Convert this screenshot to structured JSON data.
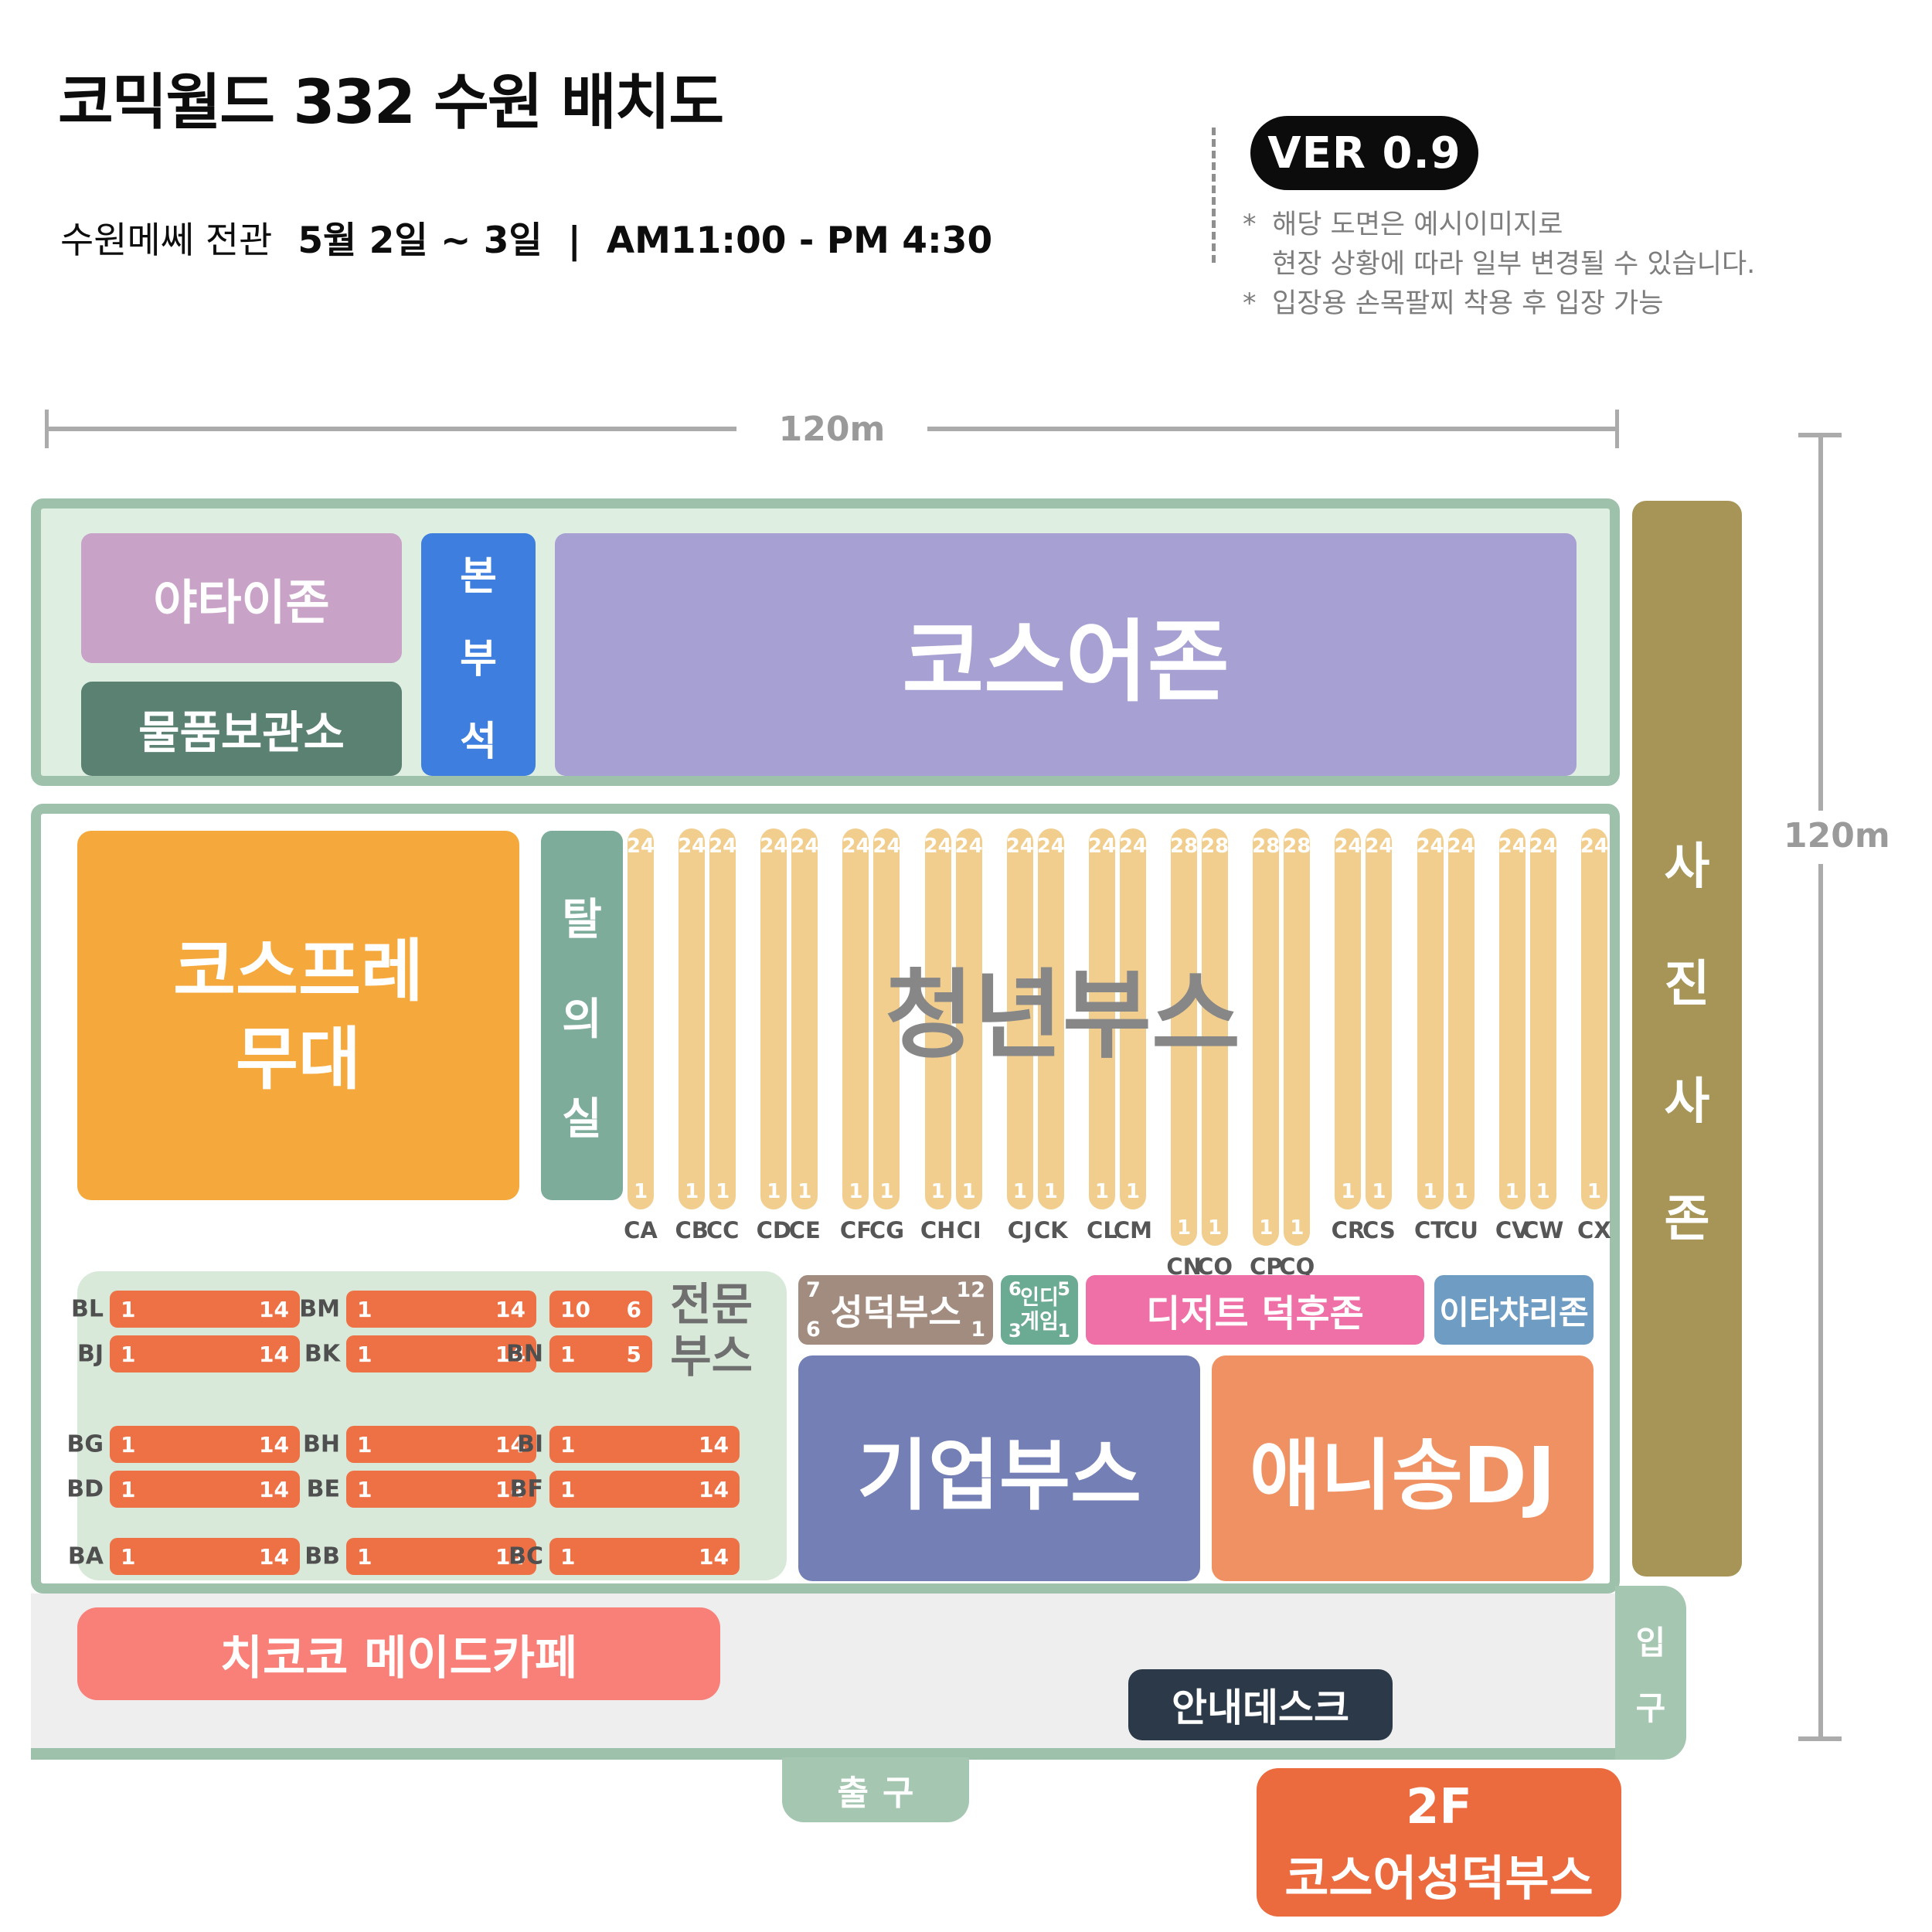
{
  "header": {
    "title": "코믹월드 332 수원 배치도",
    "subtitle_venue": "수원메쎄 전관",
    "subtitle_date": "5월 2일 ~ 3일",
    "subtitle_sep": "|",
    "subtitle_time": "AM11:00 - PM 4:30",
    "version_badge": "VER 0.9",
    "notes": [
      {
        "mark": "*",
        "line1": "해당 도면은 예시이미지로",
        "line2": "현장 상황에 따라 일부 변경될 수 있습니다."
      },
      {
        "mark": "*",
        "line1": "입장용 손목팔찌 착용 후 입장 가능",
        "line2": ""
      }
    ]
  },
  "dimensions": {
    "width_label": "120m",
    "height_label": "120m"
  },
  "zones": {
    "yatai": "야타이존",
    "storage": "물품보관소",
    "hq": "본부석",
    "cosplayer_zone": "코스어존",
    "stage_line1": "코스프레",
    "stage_line2": "무대",
    "dressing_room": "탈의실",
    "youth_booth": "청년부스",
    "dessert": "디저트 덕후존",
    "itachari": "이타챠리존",
    "corporate": "기업부스",
    "anisong": "애니송DJ",
    "photo_zone": "사진사존",
    "maid_cafe": "치코코 메이드카페",
    "info_desk": "안내데스크",
    "entrance": "입구",
    "exit": "출구",
    "floor2_line1": "2F",
    "floor2_line2": "코스어성덕부스"
  },
  "seongdeok_booth": {
    "name": "성덕부스",
    "tl": "7",
    "tr": "12",
    "bl": "6",
    "br": "1"
  },
  "indie_game": {
    "line1": "인디",
    "line2": "게임",
    "tl": "6",
    "tr": "5",
    "bl": "3",
    "br": "1"
  },
  "youth_booth": {
    "groups": [
      [
        {
          "id": "CA",
          "top": "24",
          "bottom": "1",
          "long": false
        }
      ],
      [
        {
          "id": "CB",
          "top": "24",
          "bottom": "1",
          "long": false
        },
        {
          "id": "CC",
          "top": "24",
          "bottom": "1",
          "long": false
        }
      ],
      [
        {
          "id": "CD",
          "top": "24",
          "bottom": "1",
          "long": false
        },
        {
          "id": "CE",
          "top": "24",
          "bottom": "1",
          "long": false
        }
      ],
      [
        {
          "id": "CF",
          "top": "24",
          "bottom": "1",
          "long": false
        },
        {
          "id": "CG",
          "top": "24",
          "bottom": "1",
          "long": false
        }
      ],
      [
        {
          "id": "CH",
          "top": "24",
          "bottom": "1",
          "long": false
        },
        {
          "id": "CI",
          "top": "24",
          "bottom": "1",
          "long": false
        }
      ],
      [
        {
          "id": "CJ",
          "top": "24",
          "bottom": "1",
          "long": false
        },
        {
          "id": "CK",
          "top": "24",
          "bottom": "1",
          "long": false
        }
      ],
      [
        {
          "id": "CL",
          "top": "24",
          "bottom": "1",
          "long": false
        },
        {
          "id": "CM",
          "top": "24",
          "bottom": "1",
          "long": false
        }
      ],
      [
        {
          "id": "CN",
          "top": "28",
          "bottom": "1",
          "long": true
        },
        {
          "id": "CO",
          "top": "28",
          "bottom": "1",
          "long": true
        }
      ],
      [
        {
          "id": "CP",
          "top": "28",
          "bottom": "1",
          "long": true
        },
        {
          "id": "CQ",
          "top": "28",
          "bottom": "1",
          "long": true
        }
      ],
      [
        {
          "id": "CR",
          "top": "24",
          "bottom": "1",
          "long": false
        },
        {
          "id": "CS",
          "top": "24",
          "bottom": "1",
          "long": false
        }
      ],
      [
        {
          "id": "CT",
          "top": "24",
          "bottom": "1",
          "long": false
        },
        {
          "id": "CU",
          "top": "24",
          "bottom": "1",
          "long": false
        }
      ],
      [
        {
          "id": "CV",
          "top": "24",
          "bottom": "1",
          "long": false
        },
        {
          "id": "CW",
          "top": "24",
          "bottom": "1",
          "long": false
        }
      ],
      [
        {
          "id": "CX",
          "top": "24",
          "bottom": "1",
          "long": false
        }
      ]
    ]
  },
  "pro_booth": {
    "label_line1": "전문",
    "label_line2": "부스",
    "rows": [
      {
        "cells": [
          {
            "col": 0,
            "label": "BL",
            "left": "1",
            "right": "14",
            "size": "full"
          },
          {
            "col": 1,
            "label": "BM",
            "left": "1",
            "right": "14",
            "size": "full"
          },
          {
            "col": 2,
            "label": "",
            "left": "10",
            "right": "6",
            "size": "short"
          }
        ]
      },
      {
        "cells": [
          {
            "col": 0,
            "label": "BJ",
            "left": "1",
            "right": "14",
            "size": "full"
          },
          {
            "col": 1,
            "label": "BK",
            "left": "1",
            "right": "14",
            "size": "full"
          },
          {
            "col": 2,
            "label": "BN",
            "left": "1",
            "right": "5",
            "size": "short"
          }
        ]
      },
      {
        "cells": [
          {
            "col": 0,
            "label": "BG",
            "left": "1",
            "right": "14",
            "size": "full"
          },
          {
            "col": 1,
            "label": "BH",
            "left": "1",
            "right": "14",
            "size": "full"
          },
          {
            "col": 2,
            "label": "BI",
            "left": "1",
            "right": "14",
            "size": "full"
          }
        ]
      },
      {
        "cells": [
          {
            "col": 0,
            "label": "BD",
            "left": "1",
            "right": "14",
            "size": "full"
          },
          {
            "col": 1,
            "label": "BE",
            "left": "1",
            "right": "14",
            "size": "full"
          },
          {
            "col": 2,
            "label": "BF",
            "left": "1",
            "right": "14",
            "size": "full"
          }
        ]
      },
      {
        "cells": [
          {
            "col": 0,
            "label": "BA",
            "left": "1",
            "right": "14",
            "size": "full"
          },
          {
            "col": 1,
            "label": "BB",
            "left": "1",
            "right": "14",
            "size": "full"
          },
          {
            "col": 2,
            "label": "BC",
            "left": "1",
            "right": "14",
            "size": "full"
          }
        ]
      }
    ]
  },
  "colors": {
    "map_border_green": "#9dc1aa",
    "map_fill_green": "#deeee1",
    "yatai_pink": "#c8a3c7",
    "storage_green": "#5a8172",
    "hq_blue": "#3e7ede",
    "cosplayer_purple": "#a7a0d3",
    "stage_orange": "#f5a93c",
    "dressing_teal": "#7dac9a",
    "column_tan": "#f2ce8e",
    "pro_container_green": "#d8e9da",
    "pro_bar_orange": "#ee7045",
    "seongdeok_brown": "#a28b7f",
    "indie_green": "#6cab93",
    "dessert_pink": "#ee70a6",
    "itachari_blue": "#6f9cc3",
    "corporate_indigo": "#7480b5",
    "anisong_orange": "#f09163",
    "photo_tan": "#a79557",
    "strip_gray": "#eeeeee",
    "maid_salmon": "#f98079",
    "infodesk_navy": "#2c3949",
    "floor2_orange": "#eb6a3e",
    "version_badge_black": "#0c0c0c",
    "dimension_gray": "#ababab"
  }
}
